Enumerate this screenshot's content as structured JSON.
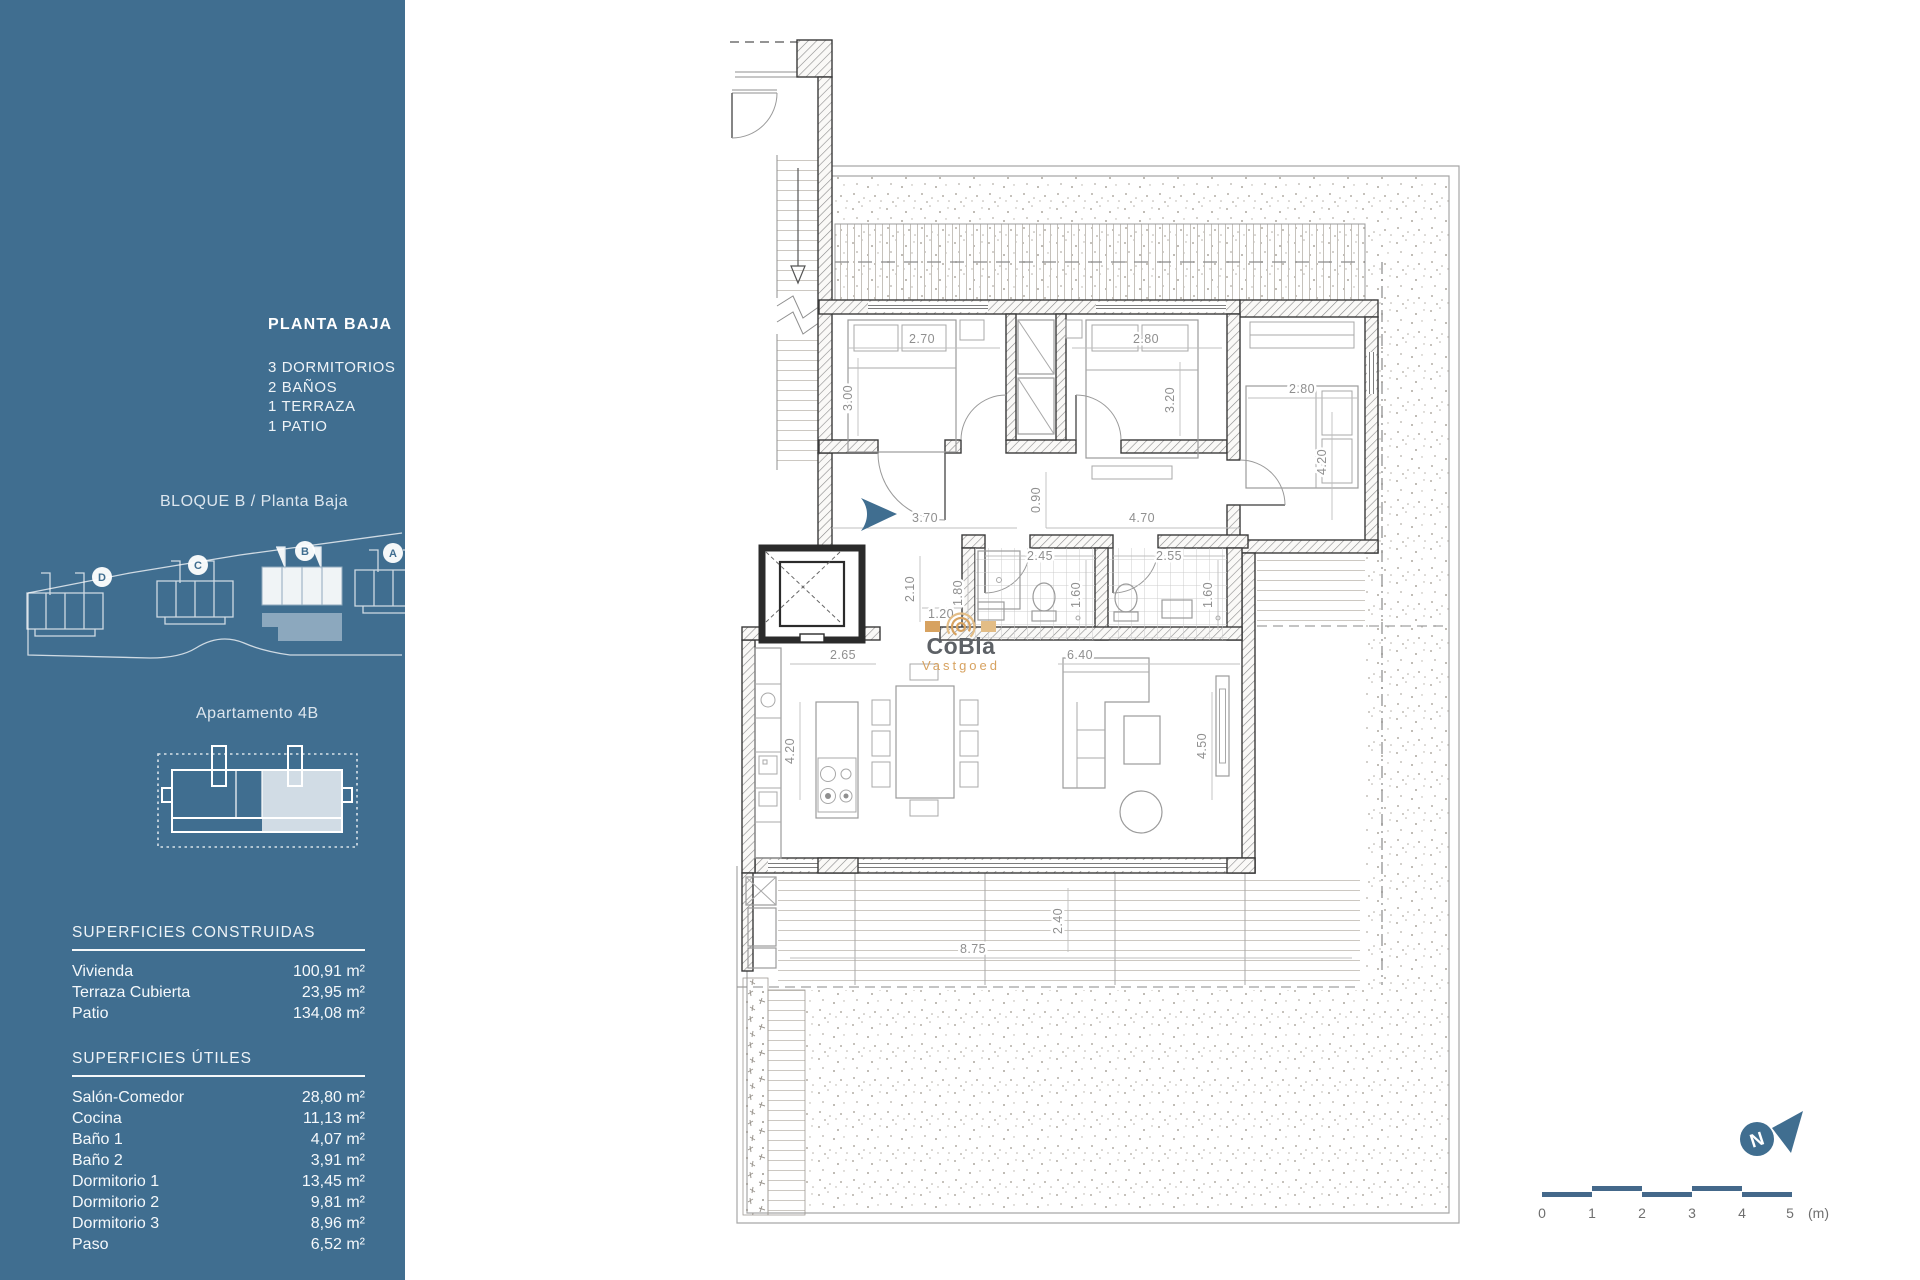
{
  "colors": {
    "sidebar_bg": "#406e90",
    "accent_blue": "#406e90",
    "watermark_tan": "#d7a260",
    "watermark_gray": "#5d6166"
  },
  "sidebar": {
    "title": "PLANTA BAJA",
    "features": [
      "3 DORMITORIOS",
      "2 BAÑOS",
      "1 TERRAZA",
      "1 PATIO"
    ],
    "block_label": "BLOQUE B / Planta Baja",
    "site_blocks": [
      "D",
      "C",
      "B",
      "A"
    ],
    "apartment_label": "Apartamento 4B",
    "built": {
      "heading": "SUPERFICIES CONSTRUIDAS",
      "rows": [
        {
          "label": "Vivienda",
          "value": "100,91 m²"
        },
        {
          "label": "Terraza Cubierta",
          "value": "23,95 m²"
        },
        {
          "label": "Patio",
          "value": "134,08 m²"
        }
      ]
    },
    "useful": {
      "heading": "SUPERFICIES ÚTILES",
      "rows": [
        {
          "label": "Salón-Comedor",
          "value": "28,80 m²"
        },
        {
          "label": "Cocina",
          "value": "11,13 m²"
        },
        {
          "label": "Baño 1",
          "value": "4,07 m²"
        },
        {
          "label": "Baño 2",
          "value": "3,91 m²"
        },
        {
          "label": "Dormitorio 1",
          "value": "13,45 m²"
        },
        {
          "label": "Dormitorio 2",
          "value": "9,81 m²"
        },
        {
          "label": "Dormitorio 3",
          "value": "8,96 m²"
        },
        {
          "label": "Paso",
          "value": "6,52 m²"
        }
      ]
    }
  },
  "plan": {
    "watermark": {
      "line1": "CoBla",
      "line2": "Vastgoed"
    },
    "north_label": "N",
    "scale": {
      "ticks": [
        "0",
        "1",
        "2",
        "3",
        "4",
        "5"
      ],
      "unit": "(m)"
    },
    "dims": {
      "bed1_w": "2.70",
      "bed1_h": "3.00",
      "bed2_w": "2.80",
      "bed2_h": "3.20",
      "bed3_w": "2.80",
      "bed3_h": "4.20",
      "hall_left": "3.70",
      "hall_mid": "0.90",
      "hall_right": "4.70",
      "bath1_w": "2.45",
      "bath1_left": "1.80",
      "bath1_h": "1.60",
      "bath2_w": "2.55",
      "bath2_h": "1.60",
      "paso_h": "2.10",
      "paso_w": "1.20",
      "kitchen_w": "2.65",
      "kitchen_h": "4.20",
      "living_w": "6.40",
      "living_h": "4.50",
      "terrace_w": "8.75",
      "terrace_h": "2.40"
    }
  }
}
